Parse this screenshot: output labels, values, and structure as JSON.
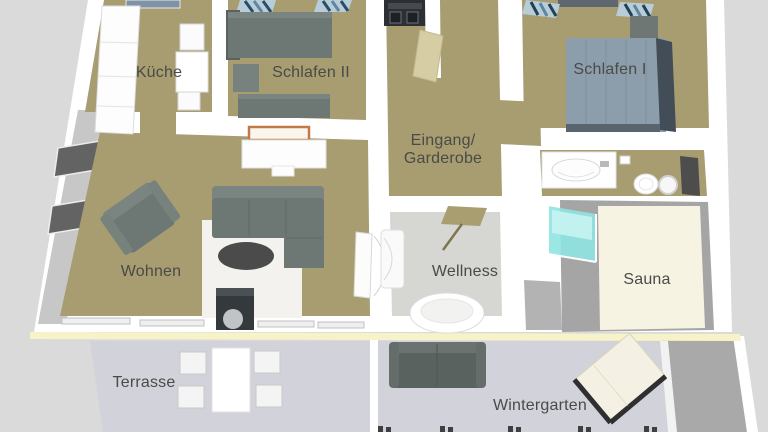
{
  "title": "Apartment floor plan (3D top view)",
  "rooms": {
    "kueche": {
      "label": "Küche",
      "furniture": [
        "tall-cabinet",
        "dining-table",
        "chairs",
        "skylight"
      ]
    },
    "schlafen2": {
      "label": "Schlafen II",
      "furniture": [
        "bed",
        "second-bed",
        "nightstand",
        "wardrobe-clothes"
      ]
    },
    "schlafen1": {
      "label": "Schlafen I",
      "furniture": [
        "double-bed",
        "nightstand",
        "wardrobe-clothes"
      ]
    },
    "eingang": {
      "label_line1": "Eingang/",
      "label_line2": "Garderobe",
      "furniture": [
        "washer-dryer",
        "open-door"
      ]
    },
    "bathroom": {
      "furniture": [
        "sink-counter",
        "toilet",
        "window"
      ]
    },
    "wohnen": {
      "label": "Wohnen",
      "furniture": [
        "armchair",
        "corner-sofa",
        "rug",
        "coffee-table",
        "sideboard",
        "picture",
        "wood-stove",
        "windows"
      ]
    },
    "wellness": {
      "label": "Wellness",
      "furniture": [
        "shower",
        "round-bathtub",
        "bath-mat",
        "glass-shower"
      ]
    },
    "sauna": {
      "label": "Sauna",
      "furniture": []
    },
    "terrasse": {
      "label": "Terrasse",
      "furniture": [
        "table",
        "chairs"
      ]
    },
    "wintergarten": {
      "label": "Wintergarten",
      "furniture": [
        "sofa",
        "lounger"
      ]
    }
  },
  "colors": {
    "background": "#dadada",
    "background_shadow": "#a9a9a9",
    "wall": "#ffffff",
    "wall_face": "#c7c7c7",
    "floor_main": "#a79d71",
    "floor_wellness": "#d6d6d3",
    "floor_sauna": "#f6f3e2",
    "floor_outdoor": "#d2d2db",
    "divider_yellow": "#f7f3c8",
    "upholstery_gray": "#6d7874",
    "bed_blue": "#8c9dab",
    "glass_cyan": "#8fe4e2",
    "picture_frame": "#c07a48",
    "label_text": "#4a4a47"
  }
}
